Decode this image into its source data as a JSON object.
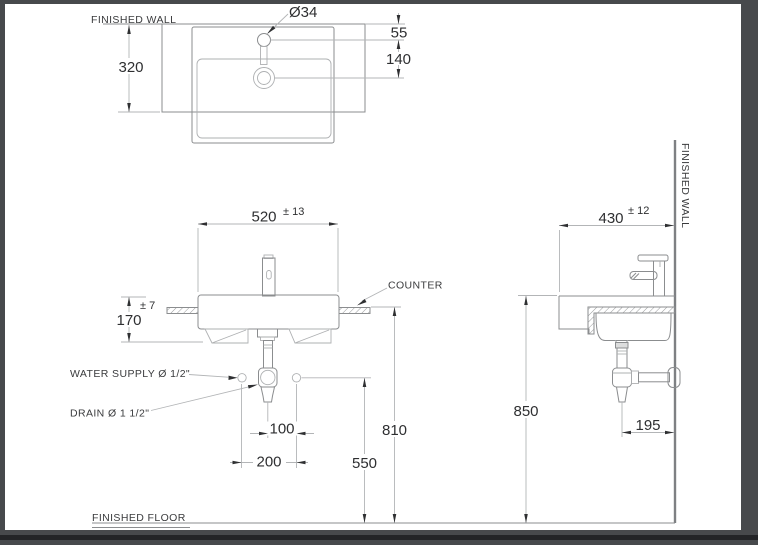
{
  "labels": {
    "finished_wall_plan": "FINISHED WALL",
    "finished_wall_side": "FINISHED WALL",
    "finished_floor": "FINISHED FLOOR",
    "counter": "COUNTER",
    "water_supply": "WATER SUPPLY Ø 1/2\"",
    "drain": "DRAIN Ø 1 1/2\""
  },
  "dims": {
    "plan": {
      "basin_depth": "320",
      "faucet_hole_dia": "Ø34",
      "wall_to_faucet": "55",
      "faucet_to_drain": "140"
    },
    "front": {
      "width": "520",
      "width_tol": "± 13",
      "height": "170",
      "height_tol": "± 7",
      "drain_to_supply": "100",
      "supply_spacing": "200",
      "supply_height": "550",
      "counter_height": "810"
    },
    "side": {
      "depth": "430",
      "depth_tol": "± 12",
      "rim_height": "850",
      "trap_to_wall": "195"
    }
  },
  "colors": {
    "frame": "#47494c",
    "sheet": "#ffffff",
    "geometry_line": "#8b8d8f",
    "dimension_line": "#b3b5b7",
    "text": "#2e2f31"
  }
}
